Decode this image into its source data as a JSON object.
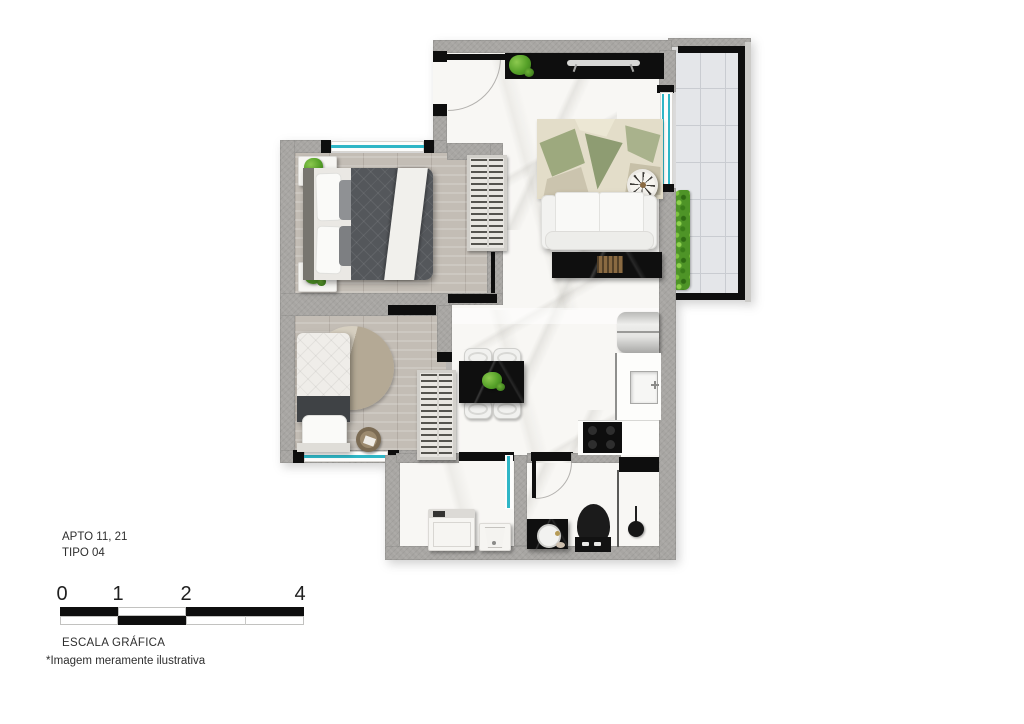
{
  "header": {
    "apartment": "APTO 11, 21",
    "type": "TIPO 04"
  },
  "scale_bar": {
    "labels": [
      "0",
      "1",
      "2",
      "4"
    ],
    "caption": "ESCALA GRÁFICA"
  },
  "footnote": "*Imagem meramente ilustrativa",
  "colors": {
    "wall": "#a8a6a3",
    "black": "#0e0e0e",
    "marble": "#f8f7f4",
    "wood": "#c3bdb5",
    "tile": "#e4e6e9",
    "glass": "#2fb6c6",
    "plant": "#55a028",
    "hedge": "#4e9427",
    "duvet": "#54575b",
    "bronze": "#8a6a42",
    "text": "#2e2e2e"
  }
}
